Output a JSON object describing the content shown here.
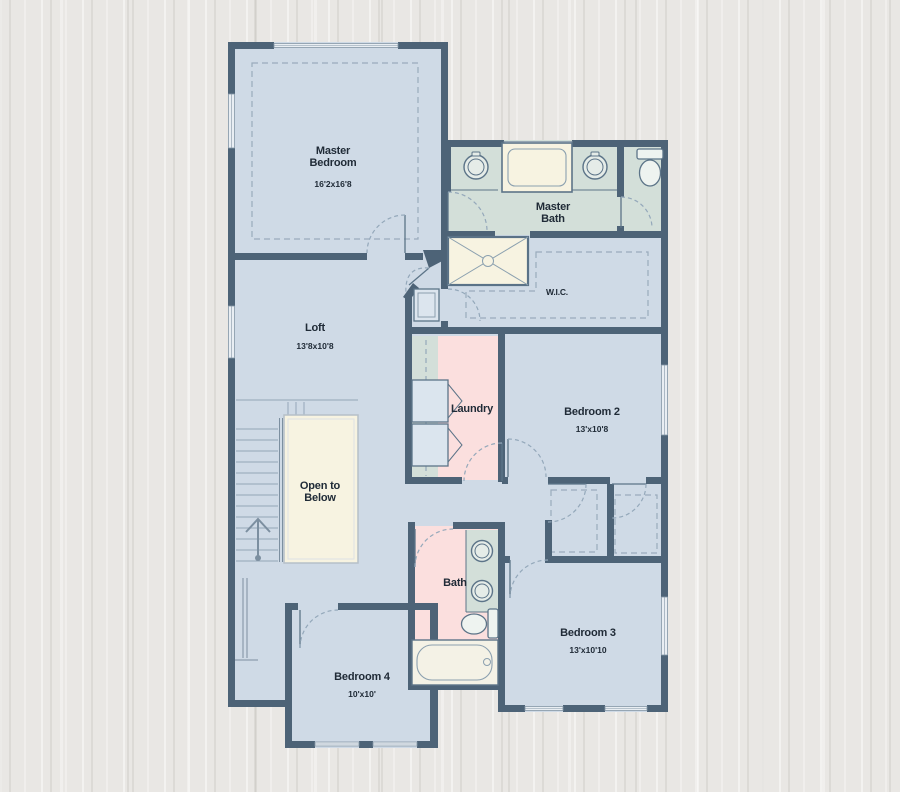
{
  "title": "Second Floor Plan",
  "labels": {
    "master_bedroom": {
      "line1": "Master",
      "line2": "Bedroom",
      "dims": "16'2x16'8"
    },
    "master_bath": {
      "line1": "Master",
      "line2": "Bath"
    },
    "wic": {
      "line1": "W.I.C."
    },
    "loft": {
      "line1": "Loft",
      "dims": "13'8x10'8"
    },
    "laundry": {
      "line1": "Laundry"
    },
    "bedroom2": {
      "line1": "Bedroom 2",
      "dims": "13'x10'8"
    },
    "open_below": {
      "line1": "Open to",
      "line2": "Below"
    },
    "bath": {
      "line1": "Bath"
    },
    "bedroom3": {
      "line1": "Bedroom 3",
      "dims": "13'x10'10"
    },
    "bedroom4": {
      "line1": "Bedroom 4",
      "dims": "10'x10'"
    }
  },
  "fixtures": [
    "garden-tub",
    "shower",
    "toilet",
    "double-sink",
    "sink",
    "washer-dryer",
    "stairs",
    "up-arrow",
    "bathtub",
    "linen-closet"
  ],
  "colors": {
    "wall": "#4d6377",
    "room_blue": "#cfdae6",
    "wet_green": "#d3dfd9",
    "laundry_pink": "#fbdfde",
    "cream": "#f7f3e1",
    "wood_background": "#e9e7e4",
    "door_arc": "#94a8ba",
    "text": "#202b37"
  }
}
